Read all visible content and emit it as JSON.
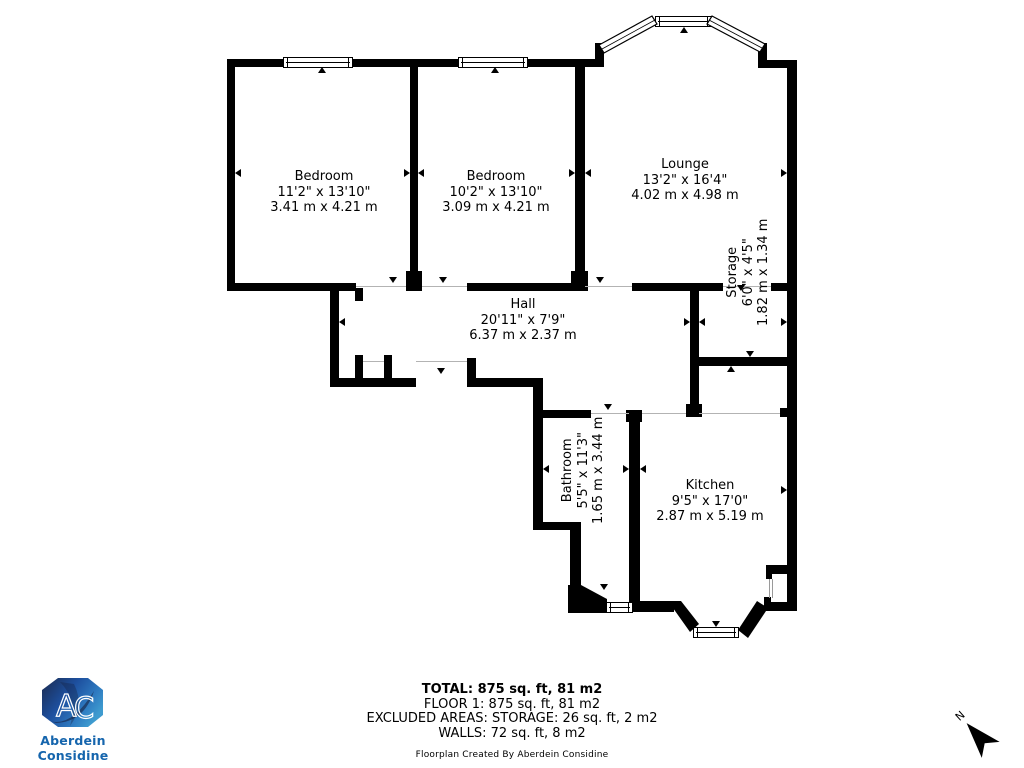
{
  "document": {
    "type": "floorplan",
    "background": "#ffffff"
  },
  "colors": {
    "wall": "#000000",
    "text": "#000000",
    "door_line": "#b3b3b3",
    "brand_wordmark_blue": "#1565ad",
    "logo_navy": "#1b2a4e",
    "logo_blue": "#1d4f9e",
    "logo_light_blue": "#3e9bcf"
  },
  "rooms": [
    {
      "id": "bedroom1",
      "name": "Bedroom",
      "imperial": "11'2\" x 13'10\"",
      "metric": "3.41 m x 4.21 m"
    },
    {
      "id": "bedroom2",
      "name": "Bedroom",
      "imperial": "10'2\" x 13'10\"",
      "metric": "3.09 m x 4.21 m"
    },
    {
      "id": "lounge",
      "name": "Lounge",
      "imperial": "13'2\" x 16'4\"",
      "metric": "4.02 m x 4.98 m"
    },
    {
      "id": "hall",
      "name": "Hall",
      "imperial": "20'11\" x 7'9\"",
      "metric": "6.37 m x 2.37 m"
    },
    {
      "id": "storage",
      "name": "Storage",
      "imperial": "6'0\" x 4'5\"",
      "metric": "1.82 m x 1.34 m",
      "rotated": true
    },
    {
      "id": "bathroom",
      "name": "Bathroom",
      "imperial": "5'5\" x 11'3\"",
      "metric": "1.65 m x 3.44 m",
      "rotated": true
    },
    {
      "id": "kitchen",
      "name": "Kitchen",
      "imperial": "9'5\" x 17'0\"",
      "metric": "2.87 m x 5.19 m"
    }
  ],
  "summary": {
    "total": "TOTAL: 875 sq. ft, 81 m2",
    "floor1": "FLOOR 1: 875 sq. ft, 81 m2",
    "excluded": "EXCLUDED AREAS: STORAGE: 26 sq. ft, 2 m2",
    "walls": "WALLS: 72 sq. ft, 8 m2",
    "credit": "Floorplan Created By Aberdein Considine"
  },
  "branding": {
    "logo_letters": [
      "A",
      "C"
    ],
    "wordmark": "Aberdein Considine"
  },
  "compass": {
    "label": "N"
  }
}
